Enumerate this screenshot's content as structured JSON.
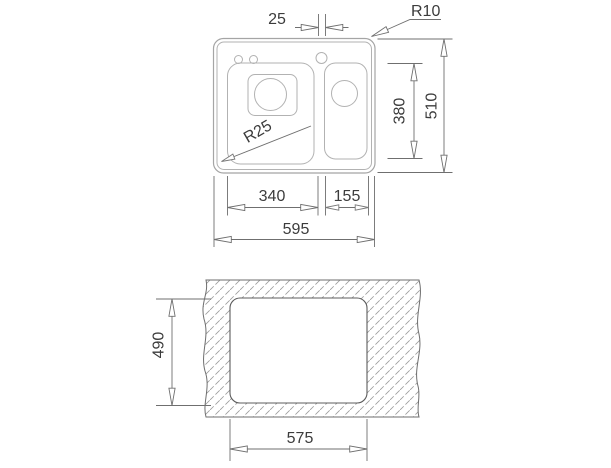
{
  "colors": {
    "background": "#ffffff",
    "sink_outline": "#a5a5a5",
    "dimension_lines": "#6f6f6f",
    "text": "#3c3c3c",
    "hatch": "#9b9b9b"
  },
  "top_view": {
    "dims": {
      "bowl_gap": "25",
      "rim_corner_radius": "R10",
      "bowl_corner_radius": "R25",
      "right_bowl_depth": "380",
      "overall_depth": "510",
      "left_bowl_width": "340",
      "right_bowl_width": "155",
      "overall_width": "595"
    }
  },
  "cutout_view": {
    "dims": {
      "cutout_depth": "490",
      "cutout_width": "575"
    }
  }
}
